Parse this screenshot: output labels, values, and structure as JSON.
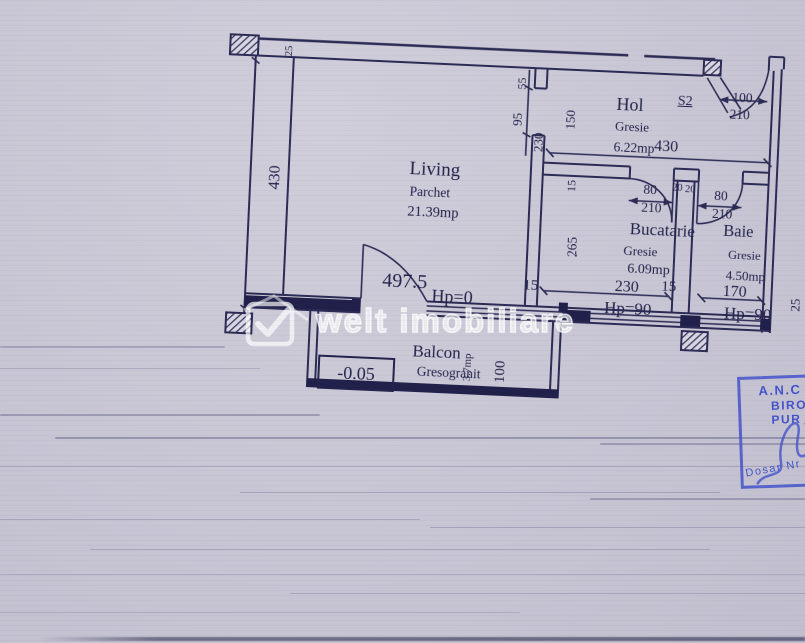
{
  "plan": {
    "living": {
      "name": "Living",
      "finish": "Parchet",
      "area": "21.39mp"
    },
    "hol": {
      "name": "Hol",
      "finish": "Gresie",
      "area": "6.22mp",
      "width": "430",
      "door_ref": "S2",
      "door_w": "100",
      "door_h": "210"
    },
    "bucatarie": {
      "name": "Bucatarie",
      "finish": "Gresie",
      "area": "6.09mp",
      "door_w": "80",
      "door_h": "210",
      "jamb_left": "20",
      "jamb_right": "20",
      "width": "230",
      "wall": "15",
      "parapet": "Hp=90"
    },
    "baie": {
      "name": "Baie",
      "finish": "Gresie",
      "area": "4.50mp",
      "door_w": "80",
      "door_h": "210",
      "width": "170",
      "parapet": "Hp=90",
      "edge": "25"
    },
    "balcon": {
      "name": "Balcon",
      "finish": "Gresogranit",
      "area": "3.7mp",
      "depth": "100",
      "level": "-0.05"
    },
    "living_dims": {
      "width": "497.5",
      "wall": "15",
      "height": "430",
      "wall_top": "25",
      "parapet": "Hp=0"
    },
    "divider_dims": {
      "seg_top": "55",
      "opening": "95",
      "seg_bottom": "230",
      "hol_width": "150",
      "wall": "15",
      "kitchen_height": "265"
    }
  },
  "watermark": {
    "text": "welt imobiliare"
  },
  "stamp": {
    "line1": "A.N.C",
    "line2": "BIRO",
    "line3": "PUR",
    "line4": "Dosar Nr"
  }
}
